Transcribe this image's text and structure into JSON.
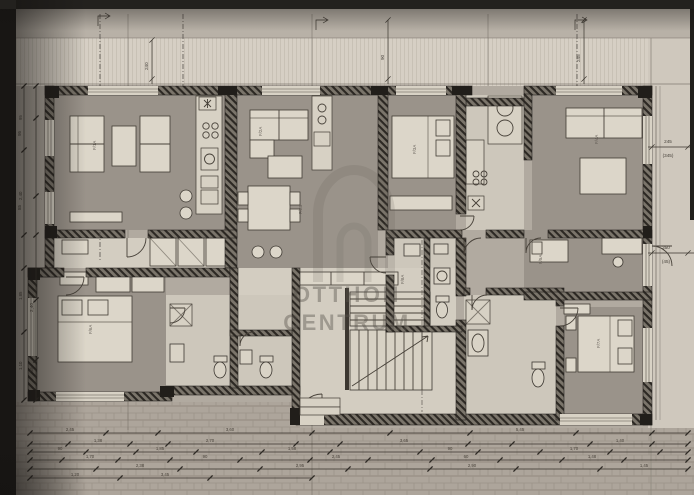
{
  "watermark": {
    "line1": "OTTHON",
    "line2": "CENTRUM"
  },
  "room_codes": [
    "F/1A",
    "F/2A",
    "F/2B",
    "F/3A",
    "F/4A",
    "F/5A",
    "F/6A",
    "F/7A",
    "F/8A"
  ],
  "dims": {
    "right": [
      "245",
      "(345)",
      "350",
      "(45)"
    ],
    "top": [
      "240",
      "90",
      "245"
    ],
    "left": [
      "95",
      "85",
      "2,40",
      "35"
    ]
  },
  "palette": {
    "paper": "#b1aaa0",
    "wall": "#2c2823",
    "room": "#9a938a",
    "watermark": "#5f5952"
  },
  "chains": [
    {
      "dir": "h",
      "y": 433,
      "x1": 30,
      "x2": 688,
      "ticks": [
        30,
        106,
        158,
        312,
        390,
        470,
        576,
        652,
        688
      ],
      "labels": [
        {
          "x": 70,
          "t": "2,45"
        },
        {
          "x": 230,
          "t": "3,60"
        },
        {
          "x": 520,
          "t": "5,45"
        }
      ]
    },
    {
      "dir": "h",
      "y": 444,
      "x1": 30,
      "x2": 688,
      "ticks": [
        30,
        68,
        130,
        168,
        296,
        340,
        468,
        512,
        590,
        652,
        688
      ],
      "labels": [
        {
          "x": 98,
          "t": "1,38"
        },
        {
          "x": 210,
          "t": "2,70"
        },
        {
          "x": 404,
          "t": "3,65"
        },
        {
          "x": 620,
          "t": "1,40"
        }
      ]
    },
    {
      "dir": "h",
      "y": 452,
      "x1": 30,
      "x2": 688,
      "ticks": [
        30,
        86,
        136,
        196,
        262,
        330,
        420,
        478,
        540,
        610,
        660,
        688
      ],
      "labels": [
        {
          "x": 60,
          "t": "90"
        },
        {
          "x": 160,
          "t": "1,85"
        },
        {
          "x": 292,
          "t": "1,58"
        },
        {
          "x": 450,
          "t": "90"
        },
        {
          "x": 574,
          "t": "1,70"
        }
      ]
    },
    {
      "dir": "h",
      "y": 460,
      "x1": 30,
      "x2": 688,
      "ticks": [
        30,
        62,
        118,
        170,
        240,
        310,
        368,
        432,
        500,
        562,
        624,
        688
      ],
      "labels": [
        {
          "x": 90,
          "t": "1,70"
        },
        {
          "x": 205,
          "t": "90"
        },
        {
          "x": 336,
          "t": "2,45"
        },
        {
          "x": 466,
          "t": "60"
        },
        {
          "x": 592,
          "t": "1,48"
        }
      ]
    },
    {
      "dir": "h",
      "y": 469,
      "x1": 30,
      "x2": 688,
      "ticks": [
        30,
        96,
        180,
        260,
        348,
        430,
        516,
        600,
        688
      ],
      "labels": [
        {
          "x": 140,
          "t": "2,38"
        },
        {
          "x": 300,
          "t": "2,95"
        },
        {
          "x": 472,
          "t": "2,90"
        },
        {
          "x": 644,
          "t": "1,45"
        }
      ]
    },
    {
      "dir": "h",
      "y": 478,
      "x1": 30,
      "x2": 312,
      "ticks": [
        30,
        120,
        210,
        312
      ],
      "labels": [
        {
          "x": 75,
          "t": "1,20"
        },
        {
          "x": 165,
          "t": "3,45"
        }
      ]
    },
    {
      "dir": "v",
      "x": 24,
      "y1": 86,
      "y2": 400,
      "ticks": [
        86,
        150,
        235,
        268,
        332,
        400
      ],
      "labels": [
        {
          "y": 120,
          "t": "95"
        },
        {
          "y": 200,
          "t": "2,40"
        },
        {
          "y": 300,
          "t": "1,85"
        },
        {
          "y": 370,
          "t": "1,10"
        }
      ]
    },
    {
      "dir": "v",
      "x": 36,
      "y1": 86,
      "y2": 400,
      "ticks": [
        86,
        118,
        196,
        235,
        300,
        360,
        400
      ],
      "labels": []
    }
  ]
}
